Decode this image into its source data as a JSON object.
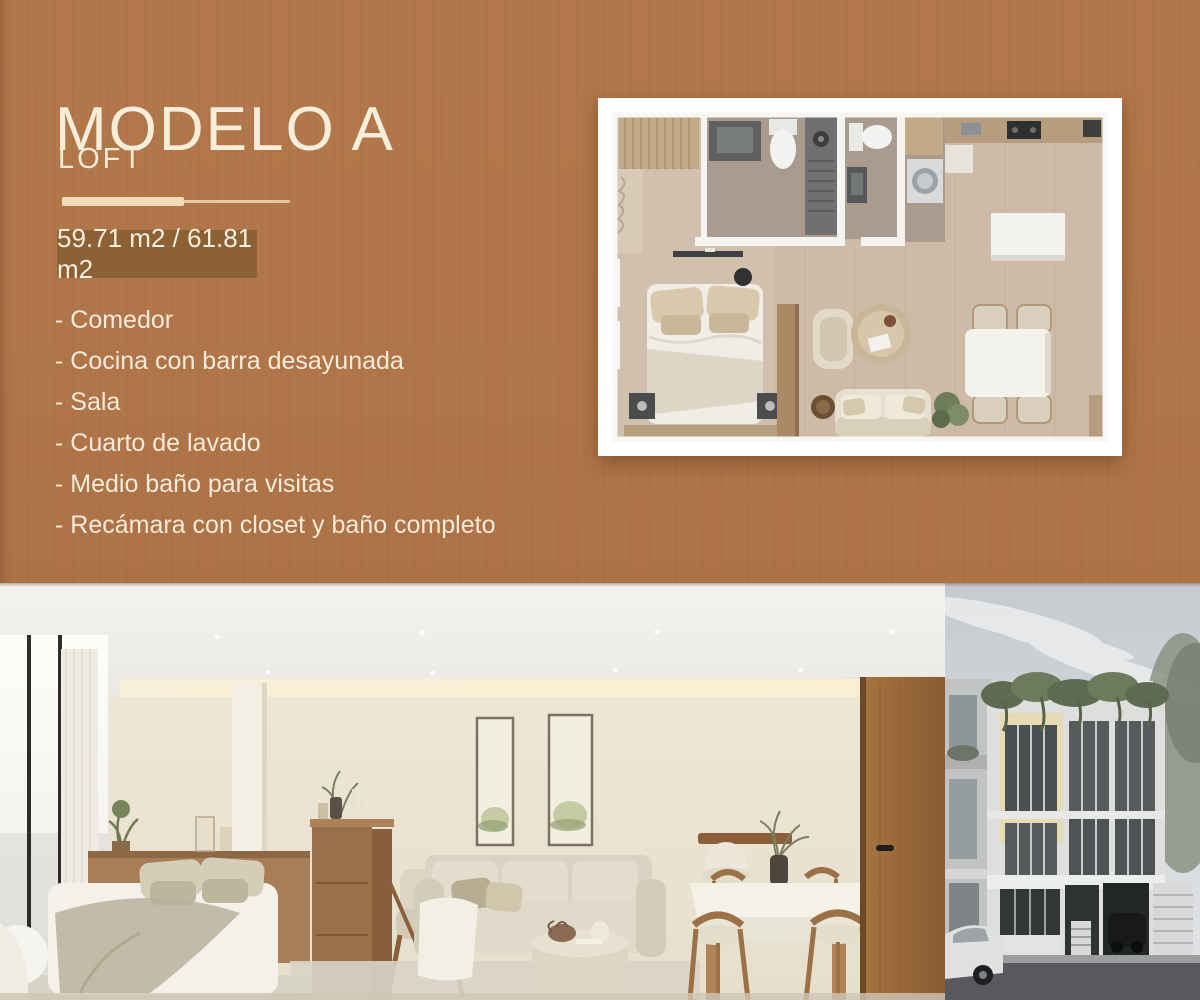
{
  "theme": {
    "background": "#b1774a",
    "badge_bg": "#8d6136",
    "badge_shadow": "#7e552e",
    "text_cream": "#f6ecd9",
    "divider": "#f3dcba"
  },
  "hero": {
    "title": "MODELO A",
    "subtitle": "LOFT",
    "area_badge": "59.71 m2 / 61.81 m2",
    "features": [
      "- Comedor",
      "- Cocina con barra desayunada",
      "- Sala",
      "- Cuarto de lavado",
      "- Medio baño para visitas",
      "- Recámara con closet y baño completo"
    ]
  },
  "images": {
    "floorplan": "floorplan-top-view-render",
    "interior": "loft-interior-render",
    "exterior": "building-facade-render"
  }
}
